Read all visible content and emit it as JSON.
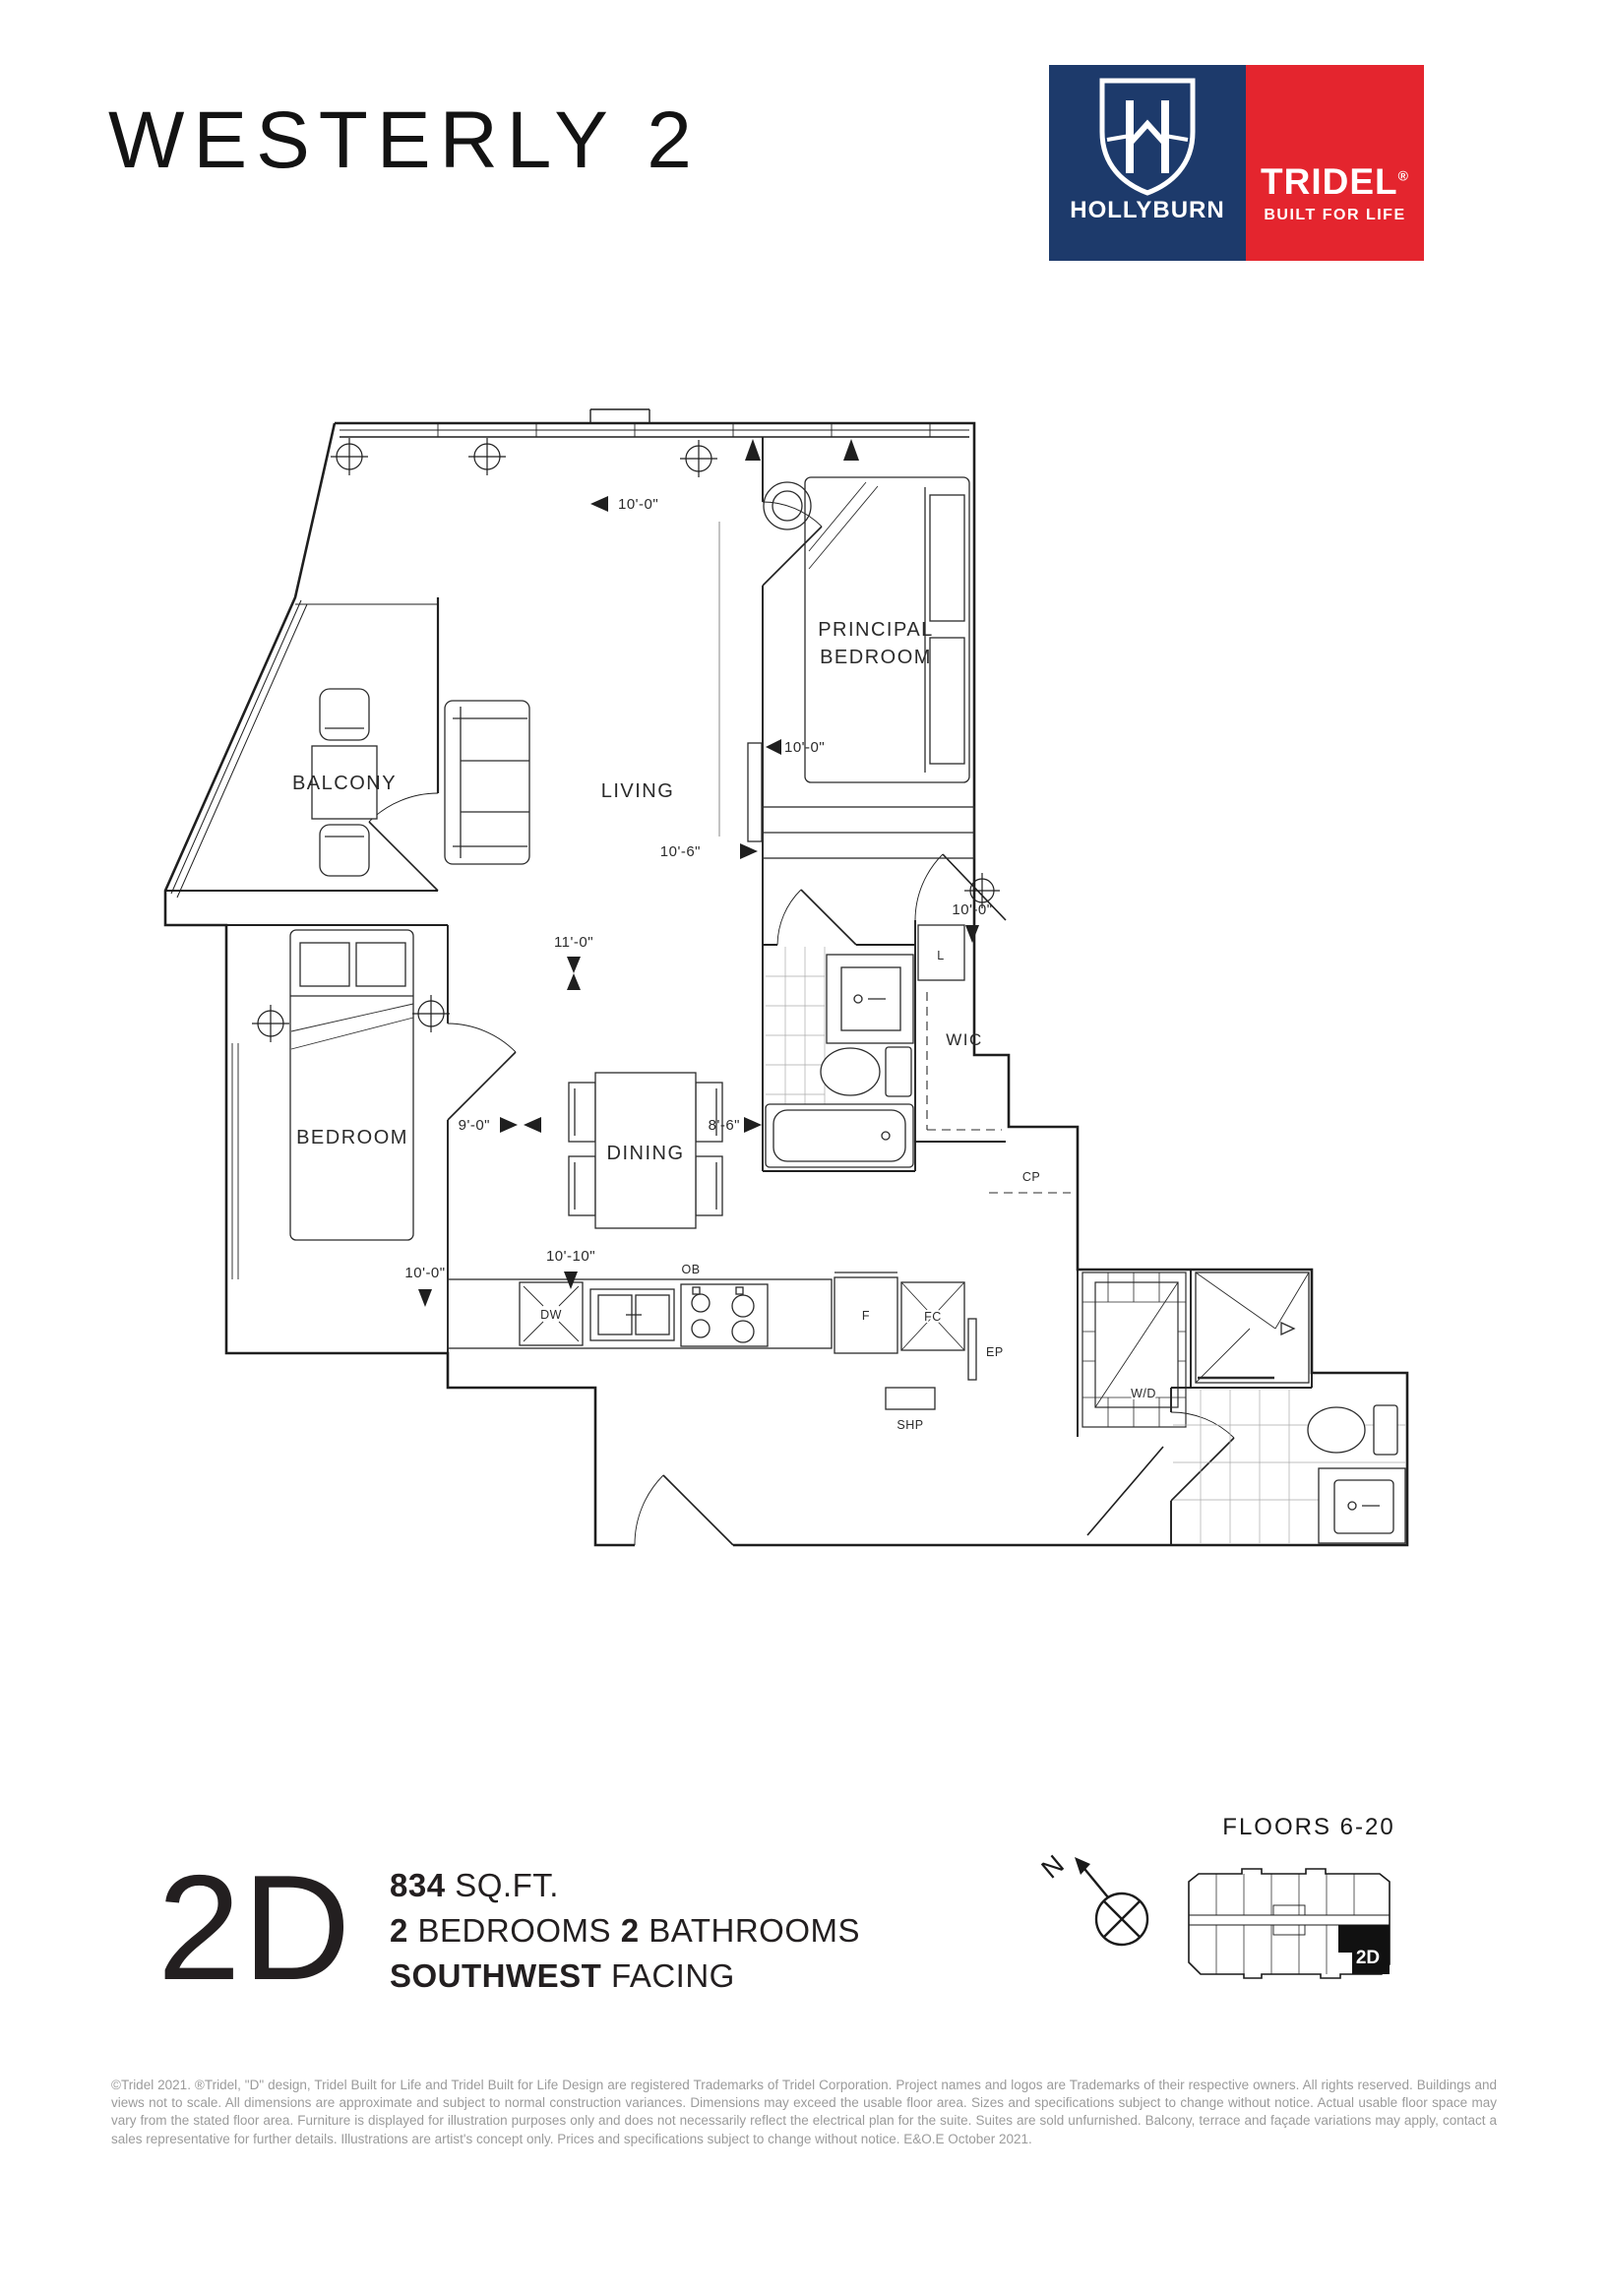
{
  "header": {
    "project_title": "WESTERLY 2"
  },
  "brand": {
    "hollyburn": {
      "name": "HOLLYBURN",
      "bg": "#1d3a6b"
    },
    "tridel": {
      "name": "TRIDEL",
      "reg": "®",
      "tagline": "BUILT FOR LIFE",
      "bg": "#e4252e"
    }
  },
  "plan": {
    "rooms": {
      "balcony": "BALCONY",
      "living": "LIVING",
      "principal_line1": "PRINCIPAL",
      "principal_line2": "BEDROOM",
      "wic": "WIC",
      "bedroom": "BEDROOM",
      "dining": "DINING"
    },
    "fixtures": {
      "linen": "L",
      "cp": "CP",
      "dw": "DW",
      "ob": "OB",
      "fridge": "F",
      "fan_coil": "FC",
      "ep": "EP",
      "shp": "SHP",
      "wd": "W/D"
    },
    "dimensions": {
      "living_width": "10'-0\"",
      "living_depth": "10'-6\"",
      "principal_width": "10'-0\"",
      "wic_width": "10'-0\"",
      "bedroom_depth": "11'-0\"",
      "hall_width": "9'-0\"",
      "bedroom_width": "10'-0\"",
      "kitchen_width": "10'-10\"",
      "dining_width": "8'-6\""
    }
  },
  "summary": {
    "unit": "2D",
    "sqft_value": "834",
    "sqft_label": "SQ.FT.",
    "bedrooms_value": "2",
    "bedrooms_label": "BEDROOMS",
    "bathrooms_value": "2",
    "bathrooms_label": "BATHROOMS",
    "facing_value": "SOUTHWEST",
    "facing_label": "FACING"
  },
  "keyplan": {
    "title": "FLOORS 6-20",
    "north": "N",
    "unit_label": "2D"
  },
  "legal": {
    "disclaimer": "©Tridel 2021. ®Tridel, \"D\" design, Tridel Built for Life and Tridel Built for Life Design are registered Trademarks of Tridel Corporation. Project names and logos are Trademarks of their respective owners. All rights reserved. Buildings and views not to scale. All dimensions are approximate and subject to normal construction variances. Dimensions may exceed the usable floor area. Sizes and specifications subject to change without notice. Actual usable floor space may vary from the stated floor area. Furniture is displayed for illustration purposes only and does not necessarily reflect the electrical plan for the suite. Suites are sold unfurnished. Balcony, terrace and façade variations may apply, contact a sales representative for further details. Illustrations are artist's concept only. Prices and specifications subject to change without notice. E&O.E October 2021."
  }
}
